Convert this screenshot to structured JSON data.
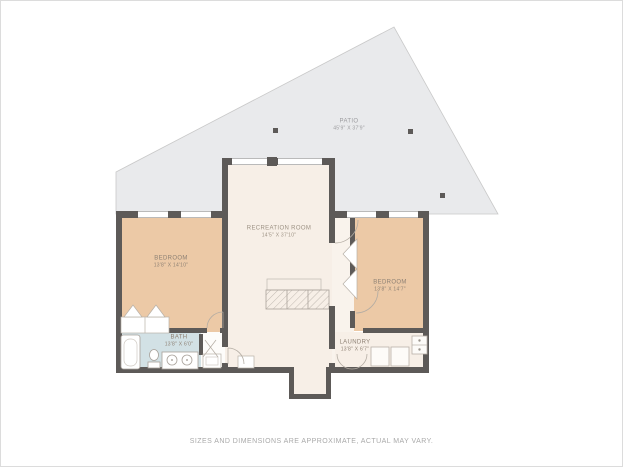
{
  "footer": {
    "disclaimer": "SIZES AND DIMENSIONS ARE APPROXIMATE, ACTUAL MAY VARY."
  },
  "rooms": {
    "patio": {
      "name": "PATIO",
      "dims": "45'9\" x 37'9\""
    },
    "recreation": {
      "name": "RECREATION ROOM",
      "dims": "14'5\" x 37'10\""
    },
    "bedroom_left": {
      "name": "BEDROOM",
      "dims": "13'8\" x 14'10\""
    },
    "bedroom_right": {
      "name": "BEDROOM",
      "dims": "13'8\" x 14'7\""
    },
    "bath": {
      "name": "BATH",
      "dims": "13'8\" x 6'0\""
    },
    "laundry": {
      "name": "LAUNDRY",
      "dims": "13'8\" x 6'7\""
    }
  },
  "colors": {
    "wall": "#5d5a58",
    "patio_fill": "#e9eaec",
    "patio_border": "#c9c9c9",
    "cream_floor": "#f7efe7",
    "bedroom_peach": "#ecc9a6",
    "bath_blue": "#d2e1e5",
    "fixture_stroke": "#b0a9a0"
  }
}
